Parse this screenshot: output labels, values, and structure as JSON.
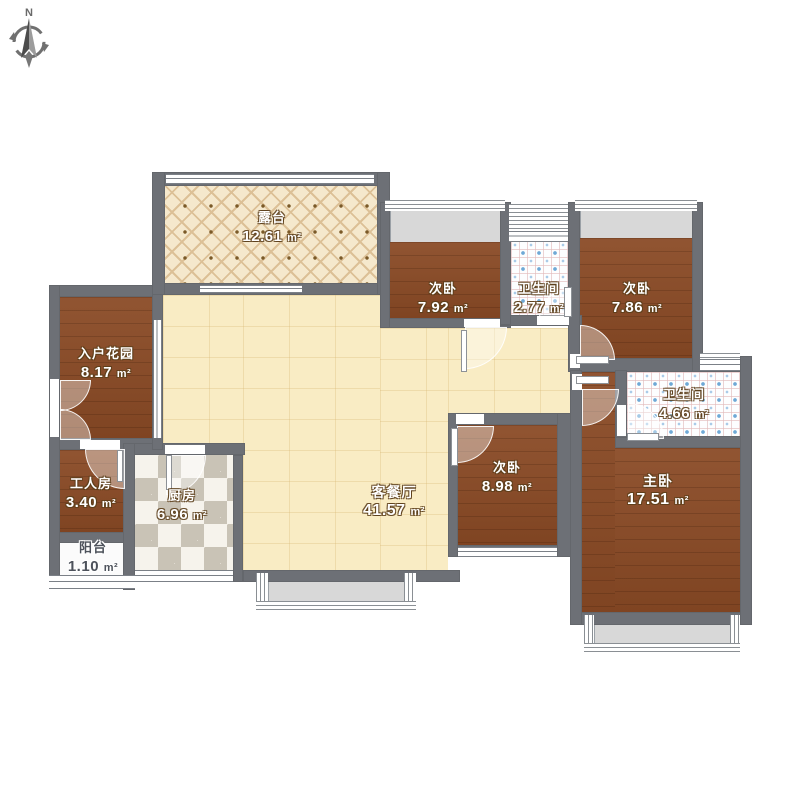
{
  "compass": {
    "label": "N"
  },
  "unit": "m²",
  "rooms": [
    {
      "key": "terrace",
      "name": "露台",
      "area": "12.61"
    },
    {
      "key": "bedroom-top-left",
      "name": "次卧",
      "area": "7.92"
    },
    {
      "key": "bathroom-top",
      "name": "卫生间",
      "area": "2.77"
    },
    {
      "key": "bedroom-top-right",
      "name": "次卧",
      "area": "7.86"
    },
    {
      "key": "entry-garden",
      "name": "入户花园",
      "area": "8.17"
    },
    {
      "key": "worker-room",
      "name": "工人房",
      "area": "3.40"
    },
    {
      "key": "kitchen",
      "name": "厨房",
      "area": "6.96"
    },
    {
      "key": "balcony",
      "name": "阳台",
      "area": "1.10"
    },
    {
      "key": "living-dining",
      "name": "客餐厅",
      "area": "41.57"
    },
    {
      "key": "bedroom-mid",
      "name": "次卧",
      "area": "8.98"
    },
    {
      "key": "master-bedroom",
      "name": "主卧",
      "area": "17.51"
    },
    {
      "key": "bathroom-master",
      "name": "卫生间",
      "area": "4.66"
    }
  ],
  "palette": {
    "wall": "#6d7076",
    "wood_floor": "#8a4a25",
    "living_floor": "#f9ecc4",
    "terrace_floor": "#f5e8cc",
    "bathroom_tile_blue": "#6fa9d6",
    "kitchen_dark": "#c9c3b6",
    "kitchen_light": "#f6f3ec",
    "bay_fill": "#d8d8d8",
    "window_line": "#7b8087"
  }
}
